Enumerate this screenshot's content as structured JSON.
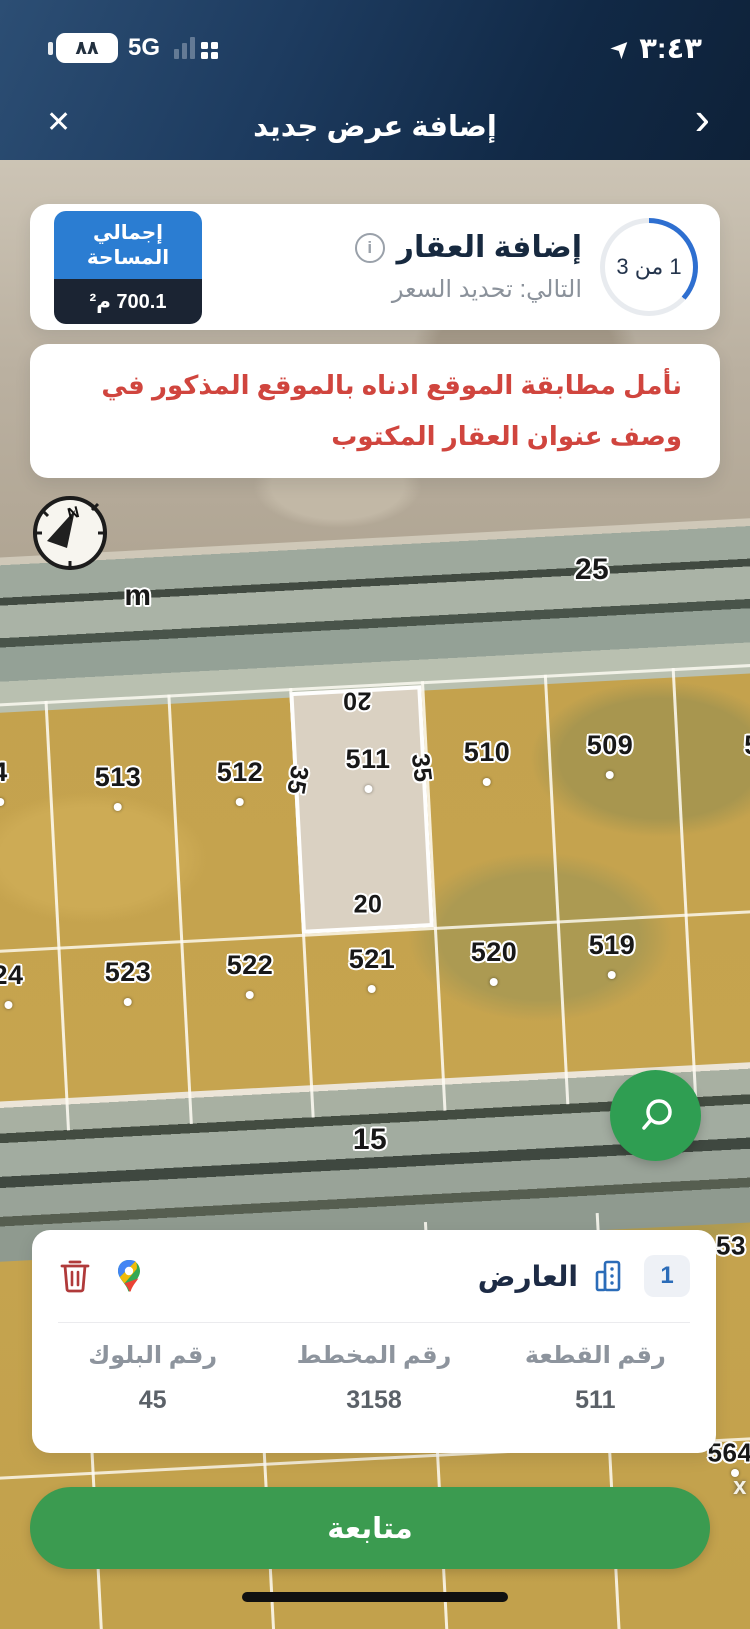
{
  "status_bar": {
    "battery": "٨٨",
    "network": "5G",
    "time": "٣:٤٣"
  },
  "navbar": {
    "title": "إضافة عرض جديد",
    "close_label": "✕",
    "back_label": "›"
  },
  "stepper": {
    "step_text": "1 من 3",
    "title": "إضافة العقار",
    "info_symbol": "i",
    "next_text": "التالي: تحديد السعر",
    "area_label": "إجمالي المساحة",
    "area_value": "700.1 م²"
  },
  "notice": {
    "text": "نأمل مطابقة الموقع ادناه بالموقع المذكور في وصف عنوان العقار المكتوب"
  },
  "map": {
    "compass_letter": "N",
    "labels": {
      "road_top_width": "25",
      "meter": "m",
      "road_bottom_width": "15",
      "dim_top": "20",
      "dim_bottom": "20",
      "dim_left": "35",
      "dim_right": "35",
      "edge_53": "53",
      "edge_564": "564",
      "edge_x": "x"
    },
    "plots_top": [
      {
        "num": "4"
      },
      {
        "num": "513"
      },
      {
        "num": "512"
      },
      {
        "num": "511"
      },
      {
        "num": "510"
      },
      {
        "num": "509"
      },
      {
        "num": "5"
      }
    ],
    "plots_bottom": [
      {
        "num": "24"
      },
      {
        "num": "523"
      },
      {
        "num": "522"
      },
      {
        "num": "521"
      },
      {
        "num": "520"
      },
      {
        "num": "519"
      }
    ]
  },
  "offer_card": {
    "count_badge": "1",
    "title": "العارض",
    "fields": [
      {
        "label": "رقم القطعة",
        "value": "511"
      },
      {
        "label": "رقم المخطط",
        "value": "3158"
      },
      {
        "label": "رقم البلوك",
        "value": "45"
      }
    ]
  },
  "actions": {
    "continue_label": "متابعة"
  },
  "colors": {
    "accent_green": "#3b9b50",
    "accent_blue": "#2b7dd2",
    "navy": "#1b2433",
    "warning_red": "#d0453e",
    "progress_blue": "#2e6fd0",
    "plot_fill": "#c4a24d",
    "highlight_fill": "#dad1c2"
  }
}
